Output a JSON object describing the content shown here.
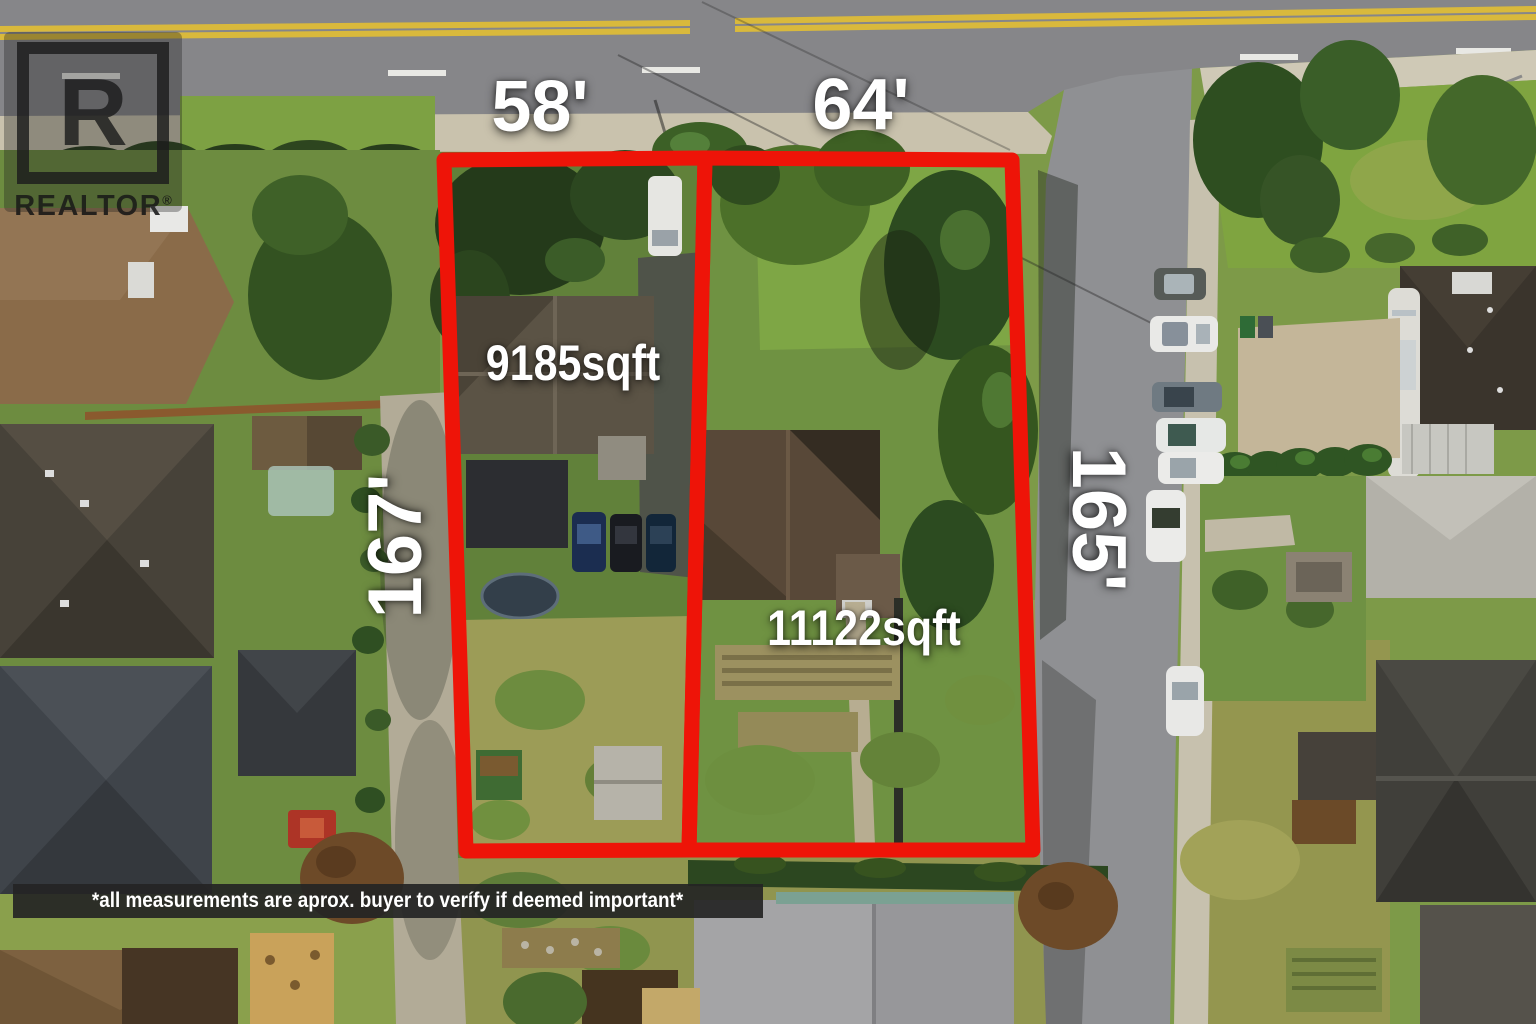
{
  "watermark": {
    "logo_letter": "R",
    "brand": "REALTOR",
    "registered": "®"
  },
  "lots": [
    {
      "frontage_label": "58'",
      "depth_label": "167'",
      "area_label": "9185sqft"
    },
    {
      "frontage_label": "64'",
      "depth_label": "165'",
      "area_label": "11122sqft"
    }
  ],
  "disclaimer": "*all measurements are aprox. buyer to verífy if deemed important*",
  "colors": {
    "lot_outline": "#ee1408",
    "label_text": "#ffffff",
    "watermark_ink": "#1c1c1c",
    "disclaimer_bg": "#242424",
    "disclaimer_text": "#ffffff"
  }
}
